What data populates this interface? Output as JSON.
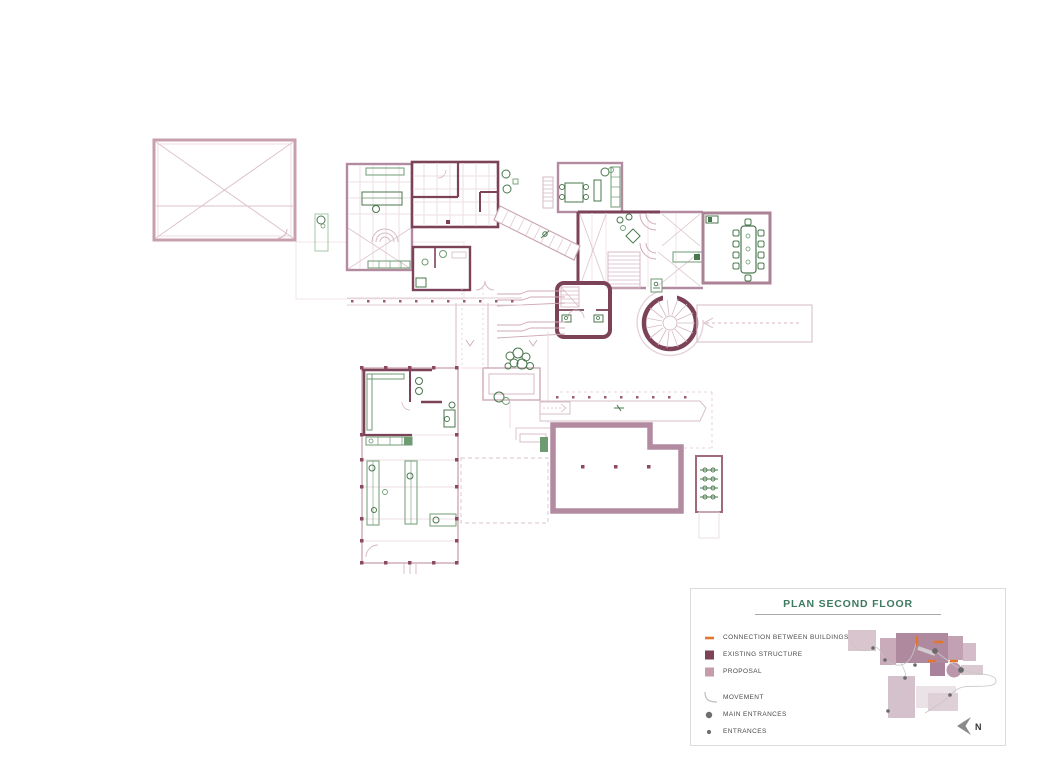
{
  "legend": {
    "title": "PLAN SECOND FLOOR",
    "items": [
      {
        "label": "CONNECTION BETWEEN BUILDINGS"
      },
      {
        "label": "EXISTING STRUCTURE"
      },
      {
        "label": "PROPOSAL"
      },
      {
        "label": "MOVEMENT"
      },
      {
        "label": "MAIN ENTRANCES"
      },
      {
        "label": "ENTRANCES"
      }
    ],
    "north_label": "N"
  },
  "colors": {
    "existing_structure": "#7c4258",
    "proposal": "#c49cab",
    "proposal_wall": "#b28ba0",
    "connection": "#e2762d",
    "movement": "#bdbdbd",
    "entrance_dot": "#6e6e6e",
    "furniture_green": "#49774e",
    "light_green": "#6f9b73",
    "title_green": "#3e7a60",
    "light_line": "#d5b9c5",
    "faint_line": "#e9dae1"
  }
}
